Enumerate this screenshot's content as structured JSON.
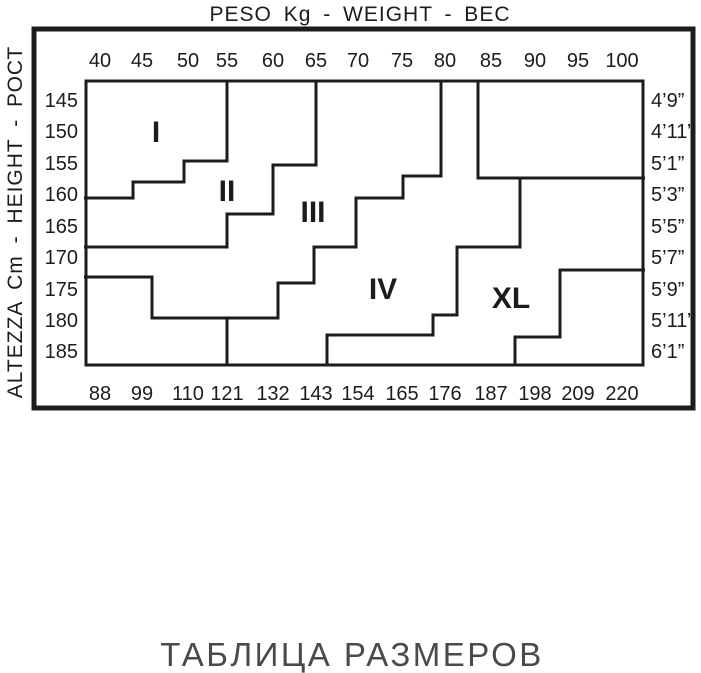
{
  "titles": {
    "top": "PESO Kg - WEIGHT - ВЕС",
    "left": "ALTEZZA Cm - HEIGHT - РОСТ",
    "bottom": "ТАБЛИЦА РАЗМЕРОВ"
  },
  "colors": {
    "ink": "#1c1c1c",
    "caption": "#4a4a4a",
    "background": "#ffffff"
  },
  "chart_data": {
    "type": "step-grid-size-chart",
    "title": "ТАБЛИЦА РАЗМЕРОВ",
    "x_axis_top": {
      "label": "PESO Kg - WEIGHT - ВЕС",
      "units": "kg",
      "ticks": [
        40,
        45,
        50,
        55,
        60,
        65,
        70,
        75,
        80,
        85,
        90,
        95,
        100
      ]
    },
    "x_axis_bottom": {
      "units": "lbs",
      "ticks": [
        88,
        99,
        110,
        121,
        132,
        143,
        154,
        165,
        176,
        187,
        198,
        209,
        220
      ]
    },
    "y_axis_left": {
      "label": "ALTEZZA Cm - HEIGHT - РОСТ",
      "units": "cm",
      "ticks": [
        145,
        150,
        155,
        160,
        165,
        170,
        175,
        180,
        185
      ]
    },
    "y_axis_right": {
      "units": "ft-in",
      "ticks": [
        "4’9”",
        "4’11”",
        "5’1”",
        "5’3”",
        "5’5”",
        "5’7”",
        "5’9”",
        "5’11”",
        "6’1”"
      ]
    },
    "sizes": [
      "I",
      "II",
      "III",
      "IV",
      "XL"
    ],
    "grid": false,
    "geometry": {
      "outer_box": [
        34,
        29,
        693,
        408
      ],
      "plot_box": [
        86,
        81,
        643,
        365
      ],
      "col_x": [
        100,
        142,
        188,
        227,
        273,
        316,
        358,
        402,
        445,
        491,
        535,
        578,
        622
      ],
      "row_y": [
        100,
        131,
        163,
        194,
        226,
        257,
        289,
        320,
        351
      ],
      "top_tick_y": 60,
      "bottom_tick_y": 393,
      "left_tick_x": 78,
      "right_tick_x": 651,
      "zone_labels": [
        {
          "text": "I",
          "x": 156,
          "y": 131
        },
        {
          "text": "II",
          "x": 227,
          "y": 190
        },
        {
          "text": "III",
          "x": 313,
          "y": 211
        },
        {
          "text": "IV",
          "x": 383,
          "y": 288
        },
        {
          "text": "XL",
          "x": 511,
          "y": 297
        }
      ],
      "boundaries": [
        [
          [
            227,
            81
          ],
          [
            227,
            161
          ],
          [
            184,
            161
          ],
          [
            184,
            182
          ],
          [
            133,
            182
          ],
          [
            133,
            198
          ],
          [
            84,
            198
          ]
        ],
        [
          [
            316,
            81
          ],
          [
            316,
            165
          ],
          [
            273,
            165
          ],
          [
            273,
            214
          ],
          [
            227,
            214
          ],
          [
            227,
            247
          ],
          [
            84,
            247
          ]
        ],
        [
          [
            84,
            277
          ],
          [
            152,
            277
          ],
          [
            152,
            318
          ],
          [
            278,
            318
          ],
          [
            278,
            283
          ],
          [
            314,
            283
          ],
          [
            314,
            247
          ],
          [
            356,
            247
          ],
          [
            356,
            198
          ],
          [
            403,
            198
          ],
          [
            403,
            176
          ],
          [
            441,
            176
          ],
          [
            441,
            81
          ]
        ],
        [
          [
            478,
            81
          ],
          [
            478,
            178
          ],
          [
            645,
            178
          ]
        ],
        [
          [
            520,
            178
          ],
          [
            520,
            247
          ],
          [
            457,
            247
          ],
          [
            457,
            315
          ],
          [
            433,
            315
          ],
          [
            433,
            335
          ],
          [
            327,
            335
          ],
          [
            327,
            366
          ]
        ],
        [
          [
            645,
            270
          ],
          [
            560,
            270
          ],
          [
            560,
            337
          ],
          [
            515,
            337
          ],
          [
            515,
            366
          ]
        ],
        [
          [
            227,
            318
          ],
          [
            227,
            366
          ]
        ]
      ]
    }
  }
}
